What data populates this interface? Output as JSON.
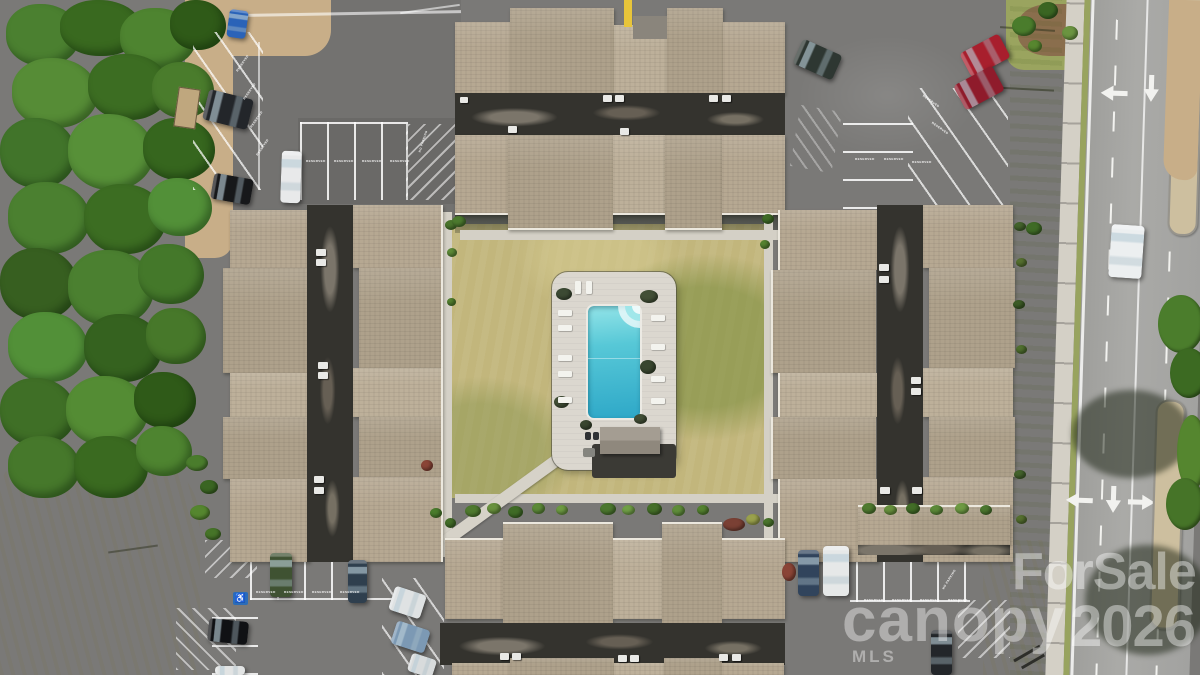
{
  "meta": {
    "type": "aerial-drone-photo",
    "subject": "Condominium complex: four shingle-roof buildings around a central courtyard with rectangular swimming pool, reserved parking lots with cars, tree stand on the left, multi-lane road on the right"
  },
  "watermark": {
    "brand_top": "ForSale",
    "brand_main": "canopy",
    "year": "2026",
    "brand_sub": "MLS"
  },
  "painted_text": {
    "reserved": "RESERVED",
    "no_parking": "NO PARKING"
  },
  "symbols": {
    "handicap": "♿"
  },
  "palette": {
    "asphalt": "#7a7977",
    "road": "#a6a6a3",
    "roof_shingle": "#b6a892",
    "flat_roof": "#34332e",
    "courtyard_grass": "#c2b67c",
    "trees": "#47782a",
    "pool_water": "#3fb7d0",
    "pool_deck": "#dbd7cf",
    "median": "#cdbf9f",
    "curb_paint_yellow": "#e8c53a"
  },
  "pool": {
    "shape": "rectangular with corner steps",
    "lounge_chair_count": 11,
    "features": [
      "concrete deck",
      "perimeter fence",
      "pool house",
      "diagonal walkway to parking"
    ]
  },
  "road": {
    "lanes": 3,
    "lane_arrows": [
      "left",
      "straight",
      "left-turn",
      "straight",
      "right-turn"
    ],
    "medians": 2
  },
  "scene_objects": {
    "foliage": [
      {
        "x": 6,
        "y": 4,
        "w": 74,
        "h": 62,
        "c": "#4b8030"
      },
      {
        "x": 60,
        "y": 0,
        "w": 82,
        "h": 56,
        "c": "#39691f"
      },
      {
        "x": 120,
        "y": 8,
        "w": 76,
        "h": 60,
        "c": "#4e8430"
      },
      {
        "x": 170,
        "y": 0,
        "w": 56,
        "h": 50,
        "c": "#2f5a18"
      },
      {
        "x": 12,
        "y": 58,
        "w": 86,
        "h": 70,
        "c": "#568c36"
      },
      {
        "x": 88,
        "y": 54,
        "w": 82,
        "h": 66,
        "c": "#3c6d22"
      },
      {
        "x": 152,
        "y": 62,
        "w": 62,
        "h": 56,
        "c": "#4a7c2c"
      },
      {
        "x": 0,
        "y": 118,
        "w": 76,
        "h": 70,
        "c": "#41742a"
      },
      {
        "x": 68,
        "y": 114,
        "w": 86,
        "h": 76,
        "c": "#579038"
      },
      {
        "x": 143,
        "y": 118,
        "w": 72,
        "h": 62,
        "c": "#36661e"
      },
      {
        "x": 8,
        "y": 182,
        "w": 82,
        "h": 72,
        "c": "#4b8030"
      },
      {
        "x": 84,
        "y": 184,
        "w": 82,
        "h": 70,
        "c": "#3c6d22"
      },
      {
        "x": 148,
        "y": 178,
        "w": 64,
        "h": 58,
        "c": "#529038"
      },
      {
        "x": 0,
        "y": 248,
        "w": 78,
        "h": 72,
        "c": "#375f20"
      },
      {
        "x": 68,
        "y": 250,
        "w": 86,
        "h": 76,
        "c": "#4b8030"
      },
      {
        "x": 138,
        "y": 244,
        "w": 66,
        "h": 60,
        "c": "#44782a"
      },
      {
        "x": 8,
        "y": 312,
        "w": 80,
        "h": 70,
        "c": "#529038"
      },
      {
        "x": 84,
        "y": 314,
        "w": 78,
        "h": 68,
        "c": "#35621f"
      },
      {
        "x": 146,
        "y": 308,
        "w": 60,
        "h": 56,
        "c": "#47782a"
      },
      {
        "x": 0,
        "y": 378,
        "w": 76,
        "h": 68,
        "c": "#3f6f26"
      },
      {
        "x": 66,
        "y": 376,
        "w": 82,
        "h": 70,
        "c": "#548c34"
      },
      {
        "x": 134,
        "y": 372,
        "w": 62,
        "h": 56,
        "c": "#2f5a18"
      },
      {
        "x": 8,
        "y": 436,
        "w": 72,
        "h": 62,
        "c": "#46782b"
      },
      {
        "x": 74,
        "y": 436,
        "w": 74,
        "h": 62,
        "c": "#3a6a20"
      },
      {
        "x": 136,
        "y": 426,
        "w": 56,
        "h": 50,
        "c": "#4e8430"
      }
    ],
    "bushes": [
      {
        "x": 465,
        "y": 505,
        "w": 16,
        "h": 12,
        "c": "#4f7a2f"
      },
      {
        "x": 487,
        "y": 503,
        "w": 14,
        "h": 11,
        "c": "#68913d"
      },
      {
        "x": 508,
        "y": 506,
        "w": 15,
        "h": 12,
        "c": "#3f6b26"
      },
      {
        "x": 532,
        "y": 503,
        "w": 13,
        "h": 11,
        "c": "#5c8a38"
      },
      {
        "x": 556,
        "y": 505,
        "w": 12,
        "h": 10,
        "c": "#6d9a42"
      },
      {
        "x": 600,
        "y": 503,
        "w": 16,
        "h": 12,
        "c": "#4b772e"
      },
      {
        "x": 622,
        "y": 505,
        "w": 13,
        "h": 10,
        "c": "#71a047"
      },
      {
        "x": 647,
        "y": 503,
        "w": 15,
        "h": 12,
        "c": "#456f28"
      },
      {
        "x": 672,
        "y": 505,
        "w": 13,
        "h": 11,
        "c": "#5f8d3a"
      },
      {
        "x": 697,
        "y": 505,
        "w": 12,
        "h": 10,
        "c": "#54822f"
      },
      {
        "x": 723,
        "y": 518,
        "w": 22,
        "h": 13,
        "c": "#7a4034"
      },
      {
        "x": 746,
        "y": 514,
        "w": 14,
        "h": 11,
        "c": "#9aa14c"
      },
      {
        "x": 862,
        "y": 503,
        "w": 14,
        "h": 11,
        "c": "#4f7a2f"
      },
      {
        "x": 884,
        "y": 505,
        "w": 13,
        "h": 10,
        "c": "#68913d"
      },
      {
        "x": 906,
        "y": 503,
        "w": 14,
        "h": 11,
        "c": "#426d27"
      },
      {
        "x": 930,
        "y": 505,
        "w": 13,
        "h": 10,
        "c": "#5c8a38"
      },
      {
        "x": 955,
        "y": 503,
        "w": 14,
        "h": 11,
        "c": "#6d9a42"
      },
      {
        "x": 980,
        "y": 505,
        "w": 12,
        "h": 10,
        "c": "#4b772e"
      },
      {
        "x": 782,
        "y": 563,
        "w": 14,
        "h": 18,
        "c": "#8a4436"
      },
      {
        "x": 445,
        "y": 220,
        "w": 12,
        "h": 10,
        "c": "#4a752c"
      },
      {
        "x": 447,
        "y": 248,
        "w": 10,
        "h": 9,
        "c": "#5d8b37"
      },
      {
        "x": 445,
        "y": 518,
        "w": 11,
        "h": 10,
        "c": "#436e28"
      },
      {
        "x": 421,
        "y": 460,
        "w": 12,
        "h": 11,
        "c": "#8a4436"
      },
      {
        "x": 447,
        "y": 298,
        "w": 9,
        "h": 8,
        "c": "#54822f"
      },
      {
        "x": 430,
        "y": 508,
        "w": 12,
        "h": 10,
        "c": "#4a7c2c"
      },
      {
        "x": 762,
        "y": 214,
        "w": 12,
        "h": 10,
        "c": "#3f6b26"
      },
      {
        "x": 760,
        "y": 240,
        "w": 10,
        "h": 9,
        "c": "#55832f"
      },
      {
        "x": 763,
        "y": 518,
        "w": 11,
        "h": 9,
        "c": "#4a752c"
      },
      {
        "x": 1014,
        "y": 222,
        "w": 12,
        "h": 9,
        "c": "#44632c"
      },
      {
        "x": 1016,
        "y": 258,
        "w": 11,
        "h": 9,
        "c": "#55702f"
      },
      {
        "x": 1013,
        "y": 300,
        "w": 12,
        "h": 9,
        "c": "#3d5c26"
      },
      {
        "x": 1016,
        "y": 345,
        "w": 11,
        "h": 9,
        "c": "#50702e"
      },
      {
        "x": 1014,
        "y": 470,
        "w": 12,
        "h": 9,
        "c": "#44632c"
      },
      {
        "x": 1016,
        "y": 515,
        "w": 11,
        "h": 9,
        "c": "#55702f"
      },
      {
        "x": 556,
        "y": 288,
        "w": 16,
        "h": 12,
        "c": "#3c4a33"
      },
      {
        "x": 640,
        "y": 290,
        "w": 18,
        "h": 13,
        "c": "#424f36"
      },
      {
        "x": 640,
        "y": 360,
        "w": 16,
        "h": 14,
        "c": "#39462f"
      },
      {
        "x": 554,
        "y": 396,
        "w": 15,
        "h": 12,
        "c": "#414e35"
      },
      {
        "x": 580,
        "y": 420,
        "w": 12,
        "h": 10,
        "c": "#39462f"
      },
      {
        "x": 634,
        "y": 414,
        "w": 13,
        "h": 10,
        "c": "#424f36"
      },
      {
        "x": 1012,
        "y": 16,
        "w": 24,
        "h": 20,
        "c": "#4a7c2c"
      },
      {
        "x": 1038,
        "y": 2,
        "w": 20,
        "h": 17,
        "c": "#3a6522"
      },
      {
        "x": 1062,
        "y": 26,
        "w": 16,
        "h": 14,
        "c": "#6b9440"
      },
      {
        "x": 1028,
        "y": 40,
        "w": 14,
        "h": 12,
        "c": "#57862f"
      },
      {
        "x": 186,
        "y": 455,
        "w": 22,
        "h": 16,
        "c": "#4a7c2c"
      },
      {
        "x": 200,
        "y": 480,
        "w": 18,
        "h": 14,
        "c": "#3a6522"
      },
      {
        "x": 190,
        "y": 505,
        "w": 20,
        "h": 15,
        "c": "#55862f"
      },
      {
        "x": 205,
        "y": 528,
        "w": 16,
        "h": 12,
        "c": "#467428"
      },
      {
        "x": 1158,
        "y": 295,
        "w": 46,
        "h": 58,
        "c": "#4b7d2c"
      },
      {
        "x": 1170,
        "y": 348,
        "w": 38,
        "h": 50,
        "c": "#3c6a22"
      },
      {
        "x": 1177,
        "y": 415,
        "w": 30,
        "h": 75,
        "c": "#55862f"
      },
      {
        "x": 1166,
        "y": 478,
        "w": 38,
        "h": 52,
        "c": "#467428"
      },
      {
        "x": 1026,
        "y": 222,
        "w": 16,
        "h": 13,
        "c": "#3f6b26"
      },
      {
        "x": 452,
        "y": 216,
        "w": 14,
        "h": 11,
        "c": "#4c7a2e"
      }
    ],
    "hvac": [
      {
        "x": 603,
        "y": 95,
        "w": 9,
        "h": 7
      },
      {
        "x": 615,
        "y": 95,
        "w": 9,
        "h": 7
      },
      {
        "x": 709,
        "y": 95,
        "w": 9,
        "h": 7
      },
      {
        "x": 722,
        "y": 95,
        "w": 9,
        "h": 7
      },
      {
        "x": 508,
        "y": 126,
        "w": 9,
        "h": 7
      },
      {
        "x": 620,
        "y": 128,
        "w": 9,
        "h": 7
      },
      {
        "x": 460,
        "y": 97,
        "w": 8,
        "h": 6
      },
      {
        "x": 316,
        "y": 249,
        "w": 10,
        "h": 7
      },
      {
        "x": 316,
        "y": 259,
        "w": 10,
        "h": 7
      },
      {
        "x": 318,
        "y": 362,
        "w": 10,
        "h": 7
      },
      {
        "x": 318,
        "y": 372,
        "w": 10,
        "h": 7
      },
      {
        "x": 314,
        "y": 476,
        "w": 10,
        "h": 7
      },
      {
        "x": 314,
        "y": 487,
        "w": 10,
        "h": 7
      },
      {
        "x": 879,
        "y": 264,
        "w": 10,
        "h": 7
      },
      {
        "x": 879,
        "y": 276,
        "w": 10,
        "h": 7
      },
      {
        "x": 911,
        "y": 377,
        "w": 10,
        "h": 7
      },
      {
        "x": 911,
        "y": 388,
        "w": 10,
        "h": 7
      },
      {
        "x": 880,
        "y": 487,
        "w": 10,
        "h": 7
      },
      {
        "x": 912,
        "y": 487,
        "w": 10,
        "h": 7
      },
      {
        "x": 500,
        "y": 653,
        "w": 9,
        "h": 7
      },
      {
        "x": 512,
        "y": 653,
        "w": 9,
        "h": 7
      },
      {
        "x": 618,
        "y": 655,
        "w": 9,
        "h": 7
      },
      {
        "x": 630,
        "y": 655,
        "w": 9,
        "h": 7
      },
      {
        "x": 719,
        "y": 654,
        "w": 9,
        "h": 7
      },
      {
        "x": 732,
        "y": 654,
        "w": 9,
        "h": 7
      }
    ],
    "chairs": [
      {
        "x": 558,
        "y": 310,
        "w": 14,
        "h": 6
      },
      {
        "x": 558,
        "y": 325,
        "w": 14,
        "h": 6
      },
      {
        "x": 558,
        "y": 355,
        "w": 14,
        "h": 6
      },
      {
        "x": 558,
        "y": 371,
        "w": 14,
        "h": 6
      },
      {
        "x": 558,
        "y": 397,
        "w": 14,
        "h": 6
      },
      {
        "x": 651,
        "y": 315,
        "w": 14,
        "h": 6
      },
      {
        "x": 651,
        "y": 344,
        "w": 14,
        "h": 6
      },
      {
        "x": 651,
        "y": 376,
        "w": 14,
        "h": 6
      },
      {
        "x": 651,
        "y": 398,
        "w": 14,
        "h": 6
      },
      {
        "x": 575,
        "y": 281,
        "w": 6,
        "h": 13
      },
      {
        "x": 586,
        "y": 281,
        "w": 6,
        "h": 13
      }
    ],
    "cans": [
      {
        "x": 585,
        "y": 432,
        "w": 6,
        "h": 8
      },
      {
        "x": 593,
        "y": 432,
        "w": 6,
        "h": 8
      },
      {
        "x": 583,
        "y": 448,
        "w": 12,
        "h": 9,
        "c": "#85857f"
      }
    ],
    "cars": [
      {
        "n": "car-blue",
        "x": 228,
        "y": 10,
        "w": 19,
        "h": 28,
        "r": 8,
        "c": "#2a63b8"
      },
      {
        "n": "car-dark-suv",
        "x": 205,
        "y": 94,
        "w": 46,
        "h": 31,
        "r": 14,
        "c": "#23262a"
      },
      {
        "n": "car-white-van",
        "x": 281,
        "y": 151,
        "w": 20,
        "h": 52,
        "r": 2,
        "c": "#e8e9ea"
      },
      {
        "n": "car-black",
        "x": 212,
        "y": 176,
        "w": 40,
        "h": 26,
        "r": 10,
        "c": "#17181a"
      },
      {
        "n": "car-dark-green",
        "x": 796,
        "y": 46,
        "w": 43,
        "h": 27,
        "r": 24,
        "c": "#2e3732"
      },
      {
        "n": "car-red-1",
        "x": 963,
        "y": 42,
        "w": 44,
        "h": 27,
        "r": -28,
        "c": "#a81f2d"
      },
      {
        "n": "car-red-2",
        "x": 957,
        "y": 74,
        "w": 44,
        "h": 28,
        "r": -28,
        "c": "#8f1b2b"
      },
      {
        "n": "car-white-on-road",
        "x": 1110,
        "y": 225,
        "w": 33,
        "h": 53,
        "r": 4,
        "c": "#eceff0"
      },
      {
        "n": "car-green-jeep",
        "x": 270,
        "y": 553,
        "w": 22,
        "h": 44,
        "r": 0,
        "c": "#3f5232"
      },
      {
        "n": "car-dark-van",
        "x": 348,
        "y": 560,
        "w": 19,
        "h": 43,
        "r": 0,
        "c": "#2f3f4e"
      },
      {
        "n": "car-black-2",
        "x": 208,
        "y": 620,
        "w": 40,
        "h": 23,
        "r": 6,
        "c": "#101114"
      },
      {
        "n": "car-white-2",
        "x": 391,
        "y": 590,
        "w": 33,
        "h": 25,
        "r": 18,
        "c": "#dfe2e3"
      },
      {
        "n": "car-light-blue",
        "x": 393,
        "y": 625,
        "w": 35,
        "h": 24,
        "r": 18,
        "c": "#7c99b4"
      },
      {
        "n": "car-white-3",
        "x": 409,
        "y": 656,
        "w": 26,
        "h": 19,
        "r": 18,
        "c": "#d8dbdc"
      },
      {
        "n": "car-dark-blue",
        "x": 798,
        "y": 550,
        "w": 21,
        "h": 46,
        "r": 0,
        "c": "#31445c"
      },
      {
        "n": "car-white-4",
        "x": 823,
        "y": 546,
        "w": 26,
        "h": 50,
        "r": 0,
        "c": "#e6e8e8"
      },
      {
        "n": "car-dark-3",
        "x": 931,
        "y": 630,
        "w": 21,
        "h": 45,
        "r": 0,
        "c": "#23262a"
      },
      {
        "n": "car-white-5",
        "x": 215,
        "y": 666,
        "w": 30,
        "h": 9,
        "r": 0,
        "c": "#e2e4e4"
      }
    ],
    "painted_labels": [
      {
        "t": "reserved",
        "x": 233,
        "y": 62,
        "r": -55
      },
      {
        "t": "reserved",
        "x": 240,
        "y": 90,
        "r": -55
      },
      {
        "t": "reserved",
        "x": 247,
        "y": 118,
        "r": -55
      },
      {
        "t": "reserved",
        "x": 253,
        "y": 146,
        "r": -55
      },
      {
        "t": "reserved",
        "x": 306,
        "y": 160,
        "r": 0
      },
      {
        "t": "reserved",
        "x": 334,
        "y": 160,
        "r": 0
      },
      {
        "t": "reserved",
        "x": 362,
        "y": 160,
        "r": 0
      },
      {
        "t": "reserved",
        "x": 390,
        "y": 160,
        "r": 0
      },
      {
        "t": "reserved",
        "x": 855,
        "y": 158,
        "r": 0
      },
      {
        "t": "reserved",
        "x": 884,
        "y": 158,
        "r": 0
      },
      {
        "t": "reserved",
        "x": 912,
        "y": 161,
        "r": 0
      },
      {
        "t": "reserved",
        "x": 921,
        "y": 100,
        "r": 35
      },
      {
        "t": "reserved",
        "x": 930,
        "y": 127,
        "r": 35
      },
      {
        "t": "reserved",
        "x": 256,
        "y": 591,
        "r": 0
      },
      {
        "t": "reserved",
        "x": 284,
        "y": 591,
        "r": 0
      },
      {
        "t": "reserved",
        "x": 312,
        "y": 591,
        "r": 0
      },
      {
        "t": "reserved",
        "x": 340,
        "y": 591,
        "r": 0
      },
      {
        "t": "reserved",
        "x": 864,
        "y": 599,
        "r": 0
      },
      {
        "t": "reserved",
        "x": 892,
        "y": 599,
        "r": 0
      },
      {
        "t": "reserved",
        "x": 920,
        "y": 599,
        "r": 0
      },
      {
        "t": "reserved",
        "x": 948,
        "y": 599,
        "r": 0
      },
      {
        "t": "no_parking",
        "x": 412,
        "y": 140,
        "r": -72
      },
      {
        "t": "no_parking",
        "x": 938,
        "y": 578,
        "r": -58
      }
    ]
  }
}
